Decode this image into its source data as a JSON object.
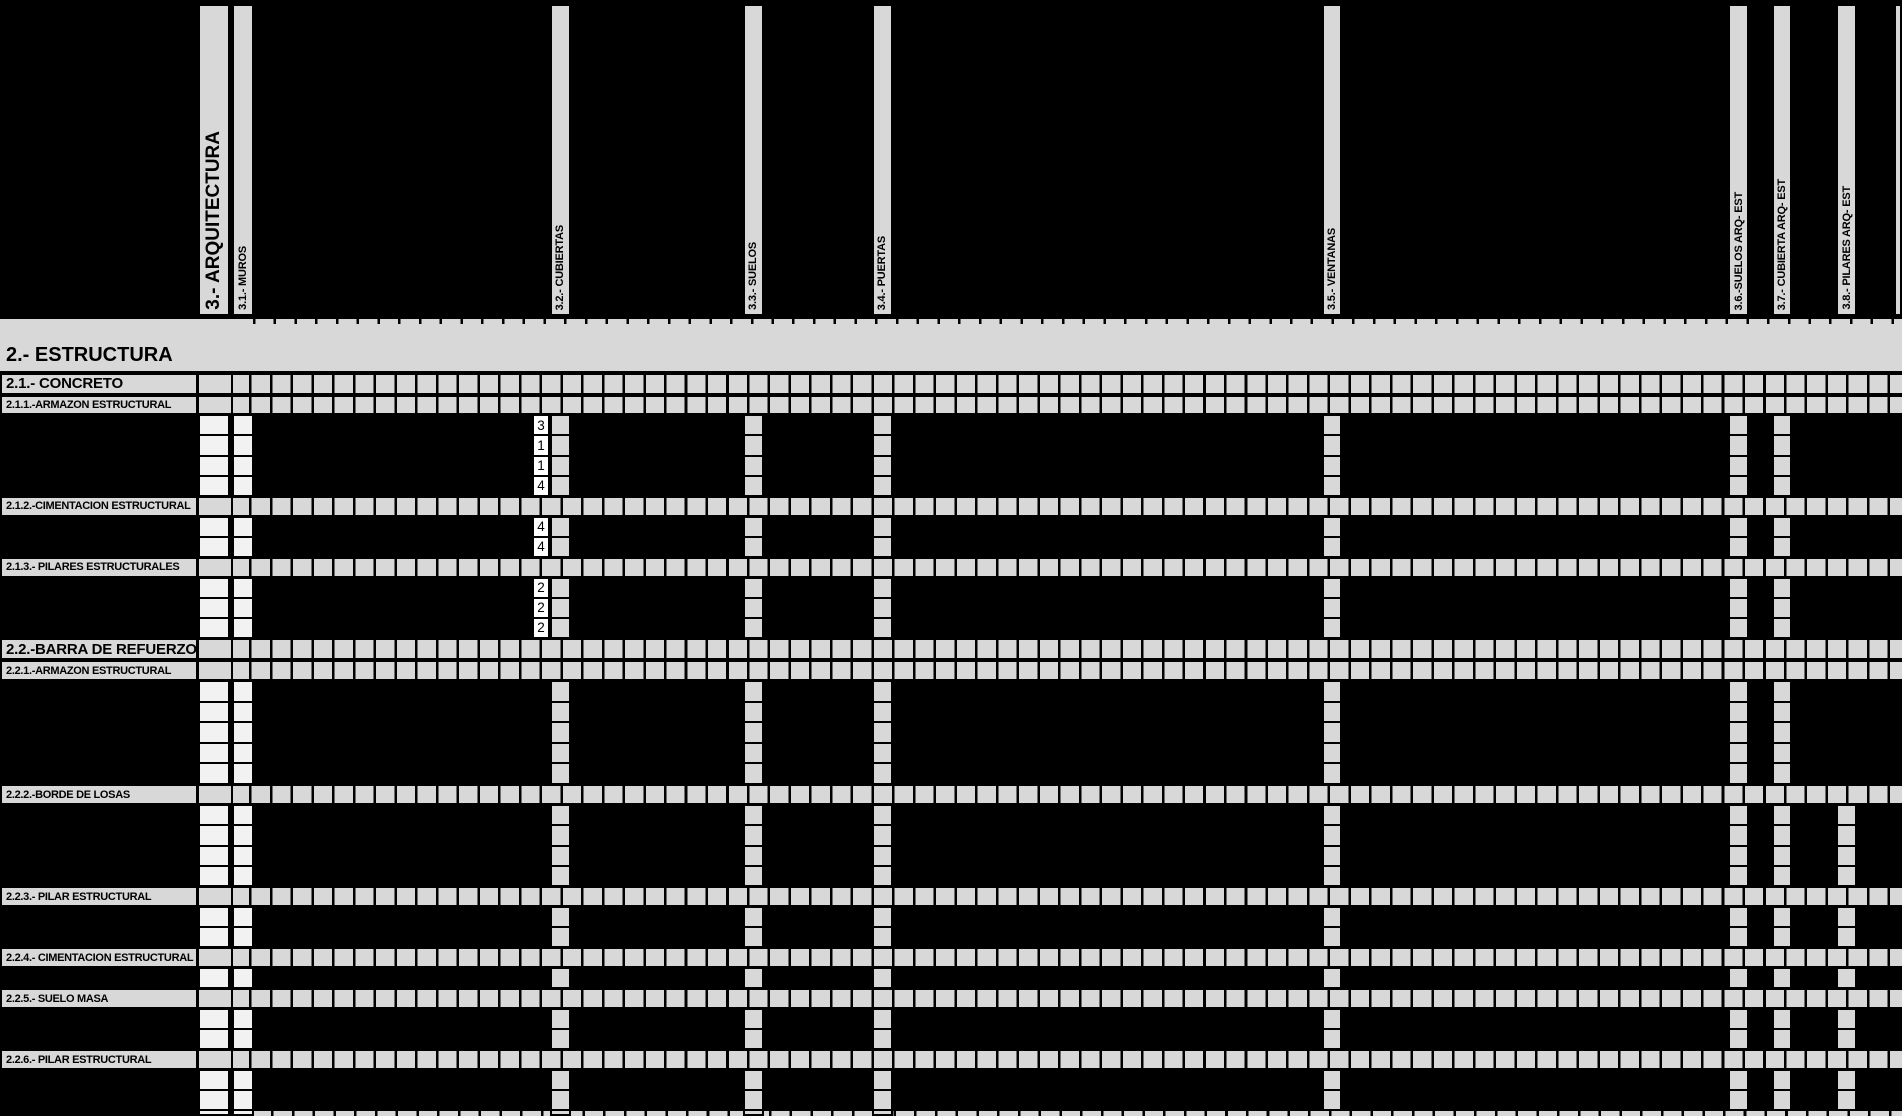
{
  "banner_label": "2.- ESTRUCTURA",
  "column_group_header": "3.- ARQUITECTURA",
  "columns": [
    {
      "id": "muros",
      "label": "3.1.- MUROS"
    },
    {
      "id": "cubiertas",
      "label": "3.2.- CUBIERTAS"
    },
    {
      "id": "suelos",
      "label": "3.3.- SUELOS"
    },
    {
      "id": "puertas",
      "label": "3.4.- PUERTAS"
    },
    {
      "id": "ventanas",
      "label": "3.5.- VENTANAS"
    },
    {
      "id": "suelos_arq_est",
      "label": "3.6.-SUELOS  ARQ- EST"
    },
    {
      "id": "cubierta_arq_est",
      "label": "3.7.- CUBIERTA ARQ- EST"
    },
    {
      "id": "pilares_arq_est",
      "label": "3.8.- PILARES  ARQ- EST"
    }
  ],
  "sections": [
    {
      "type": "section",
      "label": "2.1.- CONCRETO"
    },
    {
      "type": "subsection",
      "label": "2.1.1.-ARMAZON ESTRUCTURAL"
    },
    {
      "type": "group",
      "values": [
        "3",
        "1",
        "1",
        "4"
      ],
      "marked": [
        "arquitectura",
        "muros",
        "value",
        "cubiertas",
        "suelos",
        "puertas",
        "ventanas",
        "suelos_arq_est",
        "cubierta_arq_est"
      ]
    },
    {
      "type": "subsection",
      "label": "2.1.2.-CIMENTACION ESTRUCTURAL"
    },
    {
      "type": "group",
      "values": [
        "4",
        "4"
      ],
      "marked": [
        "arquitectura",
        "muros",
        "value",
        "cubiertas",
        "suelos",
        "puertas",
        "ventanas",
        "suelos_arq_est",
        "cubierta_arq_est"
      ]
    },
    {
      "type": "subsection",
      "label": "2.1.3.- PILARES ESTRUCTURALES"
    },
    {
      "type": "group",
      "values": [
        "2",
        "2",
        "2"
      ],
      "marked": [
        "arquitectura",
        "muros",
        "value",
        "cubiertas",
        "suelos",
        "puertas",
        "ventanas",
        "suelos_arq_est",
        "cubierta_arq_est"
      ]
    },
    {
      "type": "section",
      "label": "2.2.-BARRA DE REFUERZO"
    },
    {
      "type": "subsection",
      "label": "2.2.1.-ARMAZON ESTRUCTURAL"
    },
    {
      "type": "group",
      "rows": 5,
      "marked": [
        "arquitectura",
        "muros",
        "cubiertas",
        "suelos",
        "puertas",
        "ventanas",
        "suelos_arq_est",
        "cubierta_arq_est"
      ]
    },
    {
      "type": "subsection",
      "label": "2.2.2.-BORDE DE LOSAS"
    },
    {
      "type": "group",
      "rows": 4,
      "marked": [
        "arquitectura",
        "muros",
        "cubiertas",
        "suelos",
        "puertas",
        "ventanas",
        "suelos_arq_est",
        "cubierta_arq_est",
        "pilares_arq_est"
      ]
    },
    {
      "type": "subsection",
      "label": "2.2.3.- PILAR ESTRUCTURAL"
    },
    {
      "type": "group",
      "rows": 2,
      "marked": [
        "arquitectura",
        "muros",
        "cubiertas",
        "suelos",
        "puertas",
        "ventanas",
        "suelos_arq_est",
        "cubierta_arq_est",
        "pilares_arq_est"
      ]
    },
    {
      "type": "subsection",
      "label": "2.2.4.- CIMENTACION ESTRUCTURAL"
    },
    {
      "type": "group",
      "rows": 1,
      "marked": [
        "arquitectura",
        "muros",
        "cubiertas",
        "suelos",
        "puertas",
        "ventanas",
        "suelos_arq_est",
        "cubierta_arq_est",
        "pilares_arq_est"
      ]
    },
    {
      "type": "subsection",
      "label": "2.2.5.- SUELO MASA"
    },
    {
      "type": "group",
      "rows": 2,
      "marked": [
        "arquitectura",
        "muros",
        "cubiertas",
        "suelos",
        "puertas",
        "ventanas",
        "suelos_arq_est",
        "cubierta_arq_est",
        "pilares_arq_est"
      ]
    },
    {
      "type": "subsection",
      "label": "2.2.6.- PILAR ESTRUCTURAL"
    },
    {
      "type": "group",
      "rows": 2,
      "marked": [
        "arquitectura",
        "muros",
        "cubiertas",
        "suelos",
        "puertas",
        "ventanas",
        "suelos_arq_est",
        "cubierta_arq_est",
        "pilares_arq_est"
      ]
    }
  ],
  "colors": {
    "background": "#000000",
    "grid_gray": "#d8d8d8",
    "light_cell": "#f2f2f2",
    "value_cell_bg": "#ffffff",
    "gridline": "#000000"
  }
}
